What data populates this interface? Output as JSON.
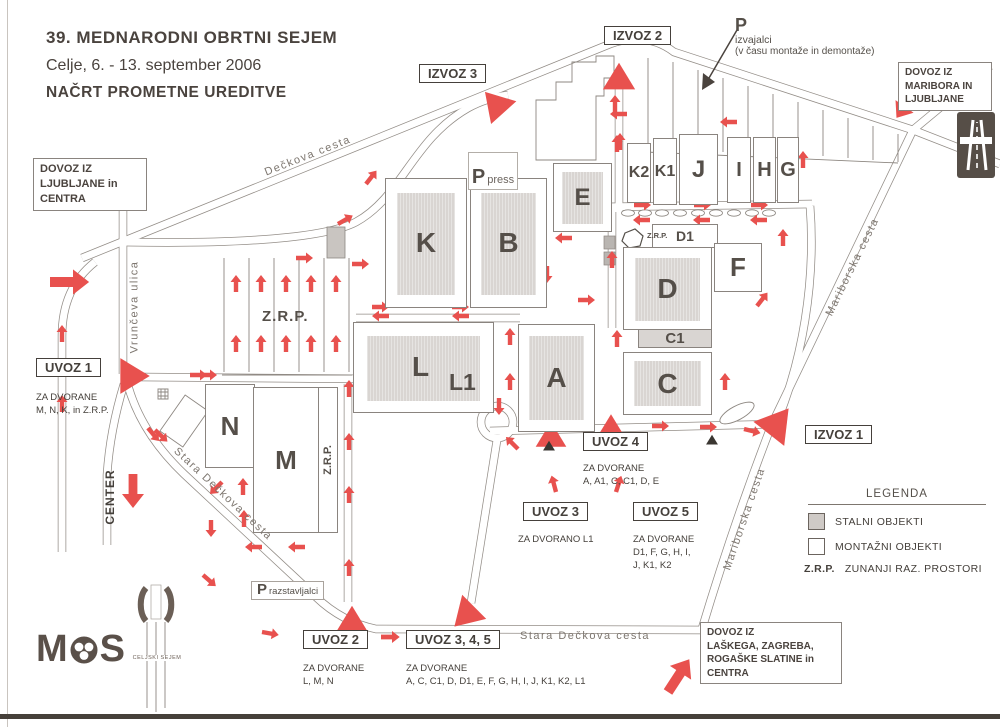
{
  "header": {
    "line1": "39. MEDNARODNI OBRTNI SEJEM",
    "line2": "Celje, 6. - 13. september 2006",
    "line3": "NAČRT PROMETNE UREDITVE"
  },
  "colors": {
    "arrow_red": "#e8514e",
    "building_fill": "#d9d5d2",
    "road_line": "#938d87",
    "text": "#4a433e"
  },
  "exits": [
    {
      "label": "IZVOZ 1"
    },
    {
      "label": "IZVOZ 2"
    },
    {
      "label": "IZVOZ 3"
    }
  ],
  "entrances": [
    {
      "label": "UVOZ 1",
      "note_lines": [
        "ZA DVORANE",
        "M, N, K, in Z.R.P."
      ]
    },
    {
      "label": "UVOZ 2",
      "note_lines": [
        "ZA DVORANE",
        "L, M, N"
      ]
    },
    {
      "label": "UVOZ 3",
      "note_lines": [
        "ZA DVORANO L1"
      ]
    },
    {
      "label": "UVOZ 4",
      "note_lines": [
        "ZA DVORANE",
        "A, A1, C, C1, D, E"
      ]
    },
    {
      "label": "UVOZ 5",
      "note_lines": [
        "ZA DVORANE",
        "D1, F, G, H, I,",
        "J, K1, K2"
      ]
    },
    {
      "label": "UVOZ 3, 4, 5",
      "note_lines": [
        "ZA DVORANE",
        "A, C, C1, D, D1, E, F, G, H, I, J, K1, K2, L1"
      ]
    }
  ],
  "access": {
    "ljubljana": {
      "lines": [
        "DOVOZ IZ",
        "LJUBLJANE in",
        "CENTRA"
      ]
    },
    "maribor": {
      "lines": [
        "DOVOZ IZ",
        "MARIBORA IN",
        "LJUBLJANE"
      ]
    },
    "lasko": {
      "lines": [
        "DOVOZ IZ",
        "LAŠKEGA, ZAGREBA,",
        "ROGAŠKE SLATINE in",
        "CENTRA"
      ]
    }
  },
  "roads": {
    "deckova": "Dečkova cesta",
    "vrunceva": "Vrunčeva ulica",
    "stara_diagonal": "Stara Dečkova cesta",
    "stara_bottom": "Stara Dečkova cesta",
    "mariborska_upper": "Mariborska cesta",
    "mariborska_lower": "Mariborska cesta",
    "center": "CENTER"
  },
  "halls": [
    {
      "id": "K",
      "label": "K"
    },
    {
      "id": "B",
      "label": "B"
    },
    {
      "id": "E",
      "label": "E"
    },
    {
      "id": "K2",
      "label": "K2"
    },
    {
      "id": "K1",
      "label": "K1"
    },
    {
      "id": "J",
      "label": "J"
    },
    {
      "id": "I",
      "label": "I"
    },
    {
      "id": "H",
      "label": "H"
    },
    {
      "id": "G",
      "label": "G"
    },
    {
      "id": "D1",
      "label": "D1"
    },
    {
      "id": "F",
      "label": "F"
    },
    {
      "id": "D",
      "label": "D"
    },
    {
      "id": "C1",
      "label": "C1"
    },
    {
      "id": "A",
      "label": "A"
    },
    {
      "id": "C",
      "label": "C"
    },
    {
      "id": "L",
      "label": "L"
    },
    {
      "id": "L1",
      "label": "L1"
    },
    {
      "id": "N",
      "label": "N"
    },
    {
      "id": "M",
      "label": "M"
    }
  ],
  "parking": {
    "press": {
      "p": "P",
      "label": "press"
    },
    "izvajalci": {
      "p": "P",
      "line1": "izvajalci",
      "line2": "(v času montaže in demontaže)"
    },
    "razstavljalci": {
      "p": "P",
      "label": "razstavljalci"
    },
    "zrp_area": "Z.R.P.",
    "zrp_side": "Z.R.P.",
    "zrp_hex": "Z.R.P."
  },
  "legend": {
    "title": "LEGENDA",
    "stalni": "STALNI OBJEKTI",
    "montazni": "MONTAŽNI OBJEKTI",
    "zrp_abbr": "Z.R.P.",
    "zrp_label": "ZUNANJI RAZ. PROSTORI"
  },
  "logos": {
    "mos_m": "M",
    "mos_s": "S",
    "celjski": "CELJSKI SEJEM"
  }
}
